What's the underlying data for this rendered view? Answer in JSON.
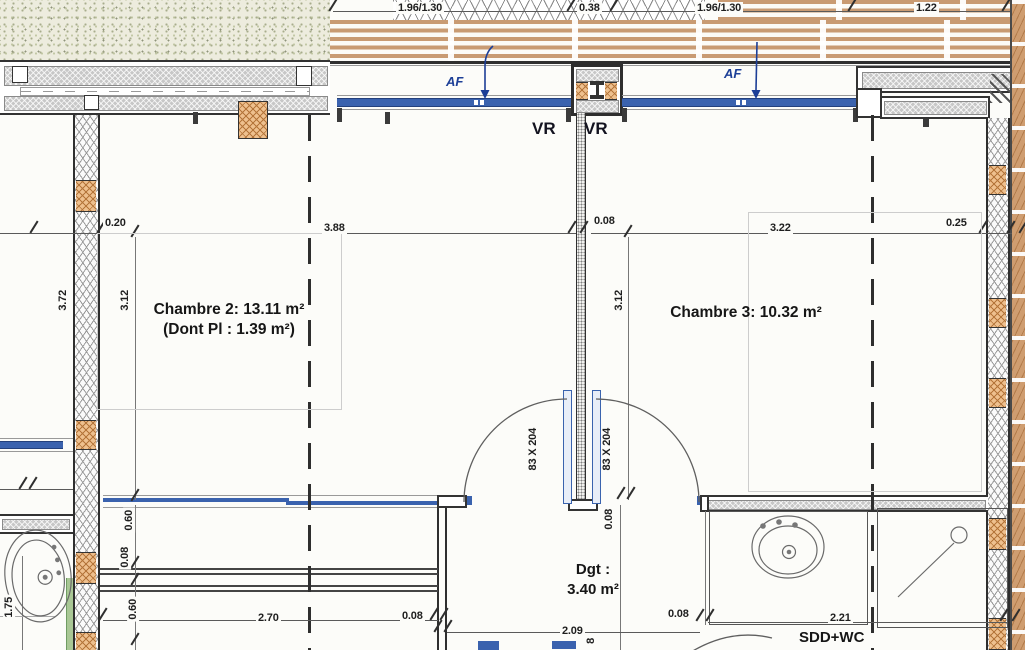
{
  "plan": {
    "rooms": {
      "chambre2": {
        "title": "Chambre 2: 13.11 m²",
        "subtitle": "(Dont Pl : 1.39 m²)"
      },
      "chambre3": {
        "title": "Chambre 3: 10.32 m²"
      },
      "dgt": {
        "title": "Dgt :",
        "area": "3.40 m²"
      },
      "sdd_wc": {
        "title": "SDD+WC"
      }
    },
    "annotations": {
      "af_left": "AF",
      "af_right": "AF",
      "vr_left": "VR",
      "vr_right": "VR",
      "door_left": "83 X 204",
      "door_right": "83 X 204"
    },
    "dimensions": {
      "top": [
        "1.96/1.30",
        "0.38",
        "1.96/1.30",
        "1.22"
      ],
      "row": [
        "0.20",
        "3.88",
        "0.08",
        "3.22",
        "0.25"
      ],
      "room_height_left": "3.12",
      "room_height_right": "3.12",
      "wall_left": "3.72",
      "door_wall": "0.08",
      "left_chain": [
        "0.60",
        "0.08",
        "0.60"
      ],
      "left_outer": "1.75",
      "cut": "8",
      "bottom": [
        "2.70",
        "0.08",
        "2.09",
        "0.08",
        "2.21"
      ]
    },
    "colors": {
      "window_blue": "#3a62ae",
      "wood_tan": "#c99b73",
      "insulation_orange": "#eec08e",
      "door_green": "#a9c795",
      "annotation_blue": "#1d3f97"
    }
  }
}
